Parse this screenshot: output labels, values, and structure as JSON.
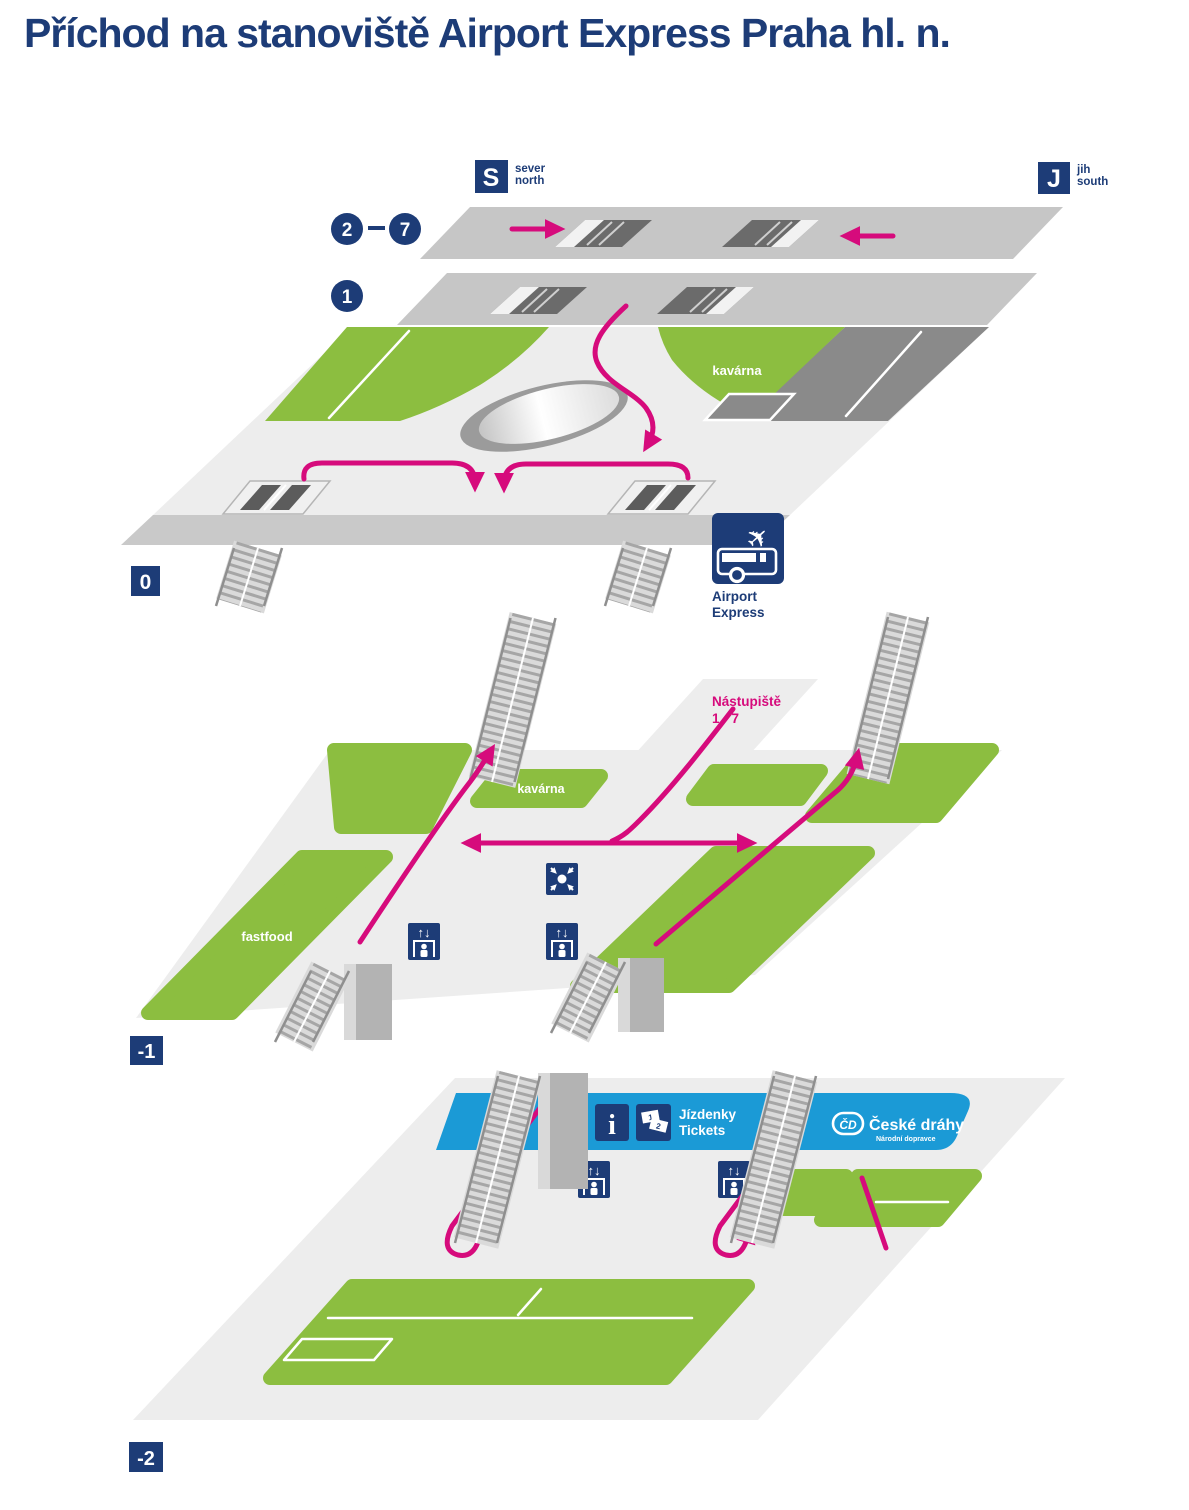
{
  "title": "Příchod na stanoviště Airport Express Praha hl. n.",
  "compass": {
    "s": "S",
    "sever": "sever",
    "north": "north",
    "j": "J",
    "jih": "jih",
    "south": "south"
  },
  "levels": {
    "l27_from": "2",
    "l27_to": "7",
    "l1": "1",
    "l0": "0",
    "lm1": "-1",
    "lm2": "-2"
  },
  "areas": {
    "cafe0": "kavárna",
    "cafe1": "kavárna",
    "fastfood": "fastfood",
    "platforms1": "Nástupiště",
    "platforms2": "1 - 7"
  },
  "airport": {
    "line1": "Airport",
    "line2": "Express"
  },
  "banner": {
    "tickets_cs": "Jízdenky",
    "tickets_en": "Tickets",
    "ticket1": "1",
    "ticket2": "2",
    "cd_logo": "ČD",
    "cd_name": "České dráhy",
    "cd_sub": "Národní dopravce"
  },
  "icons": {
    "elevator_arrows": "↑↓",
    "plane": "✈",
    "info": "i"
  },
  "colors": {
    "navy": "#1d3c77",
    "magenta": "#d60b7c",
    "green": "#8cbe40",
    "blue": "#1b9ad6",
    "floor": "#ededed",
    "mid": "#c9c9c9",
    "strip": "#c6c6c6",
    "dark": "#8a8a8a",
    "hole": "#6b6b6b"
  }
}
